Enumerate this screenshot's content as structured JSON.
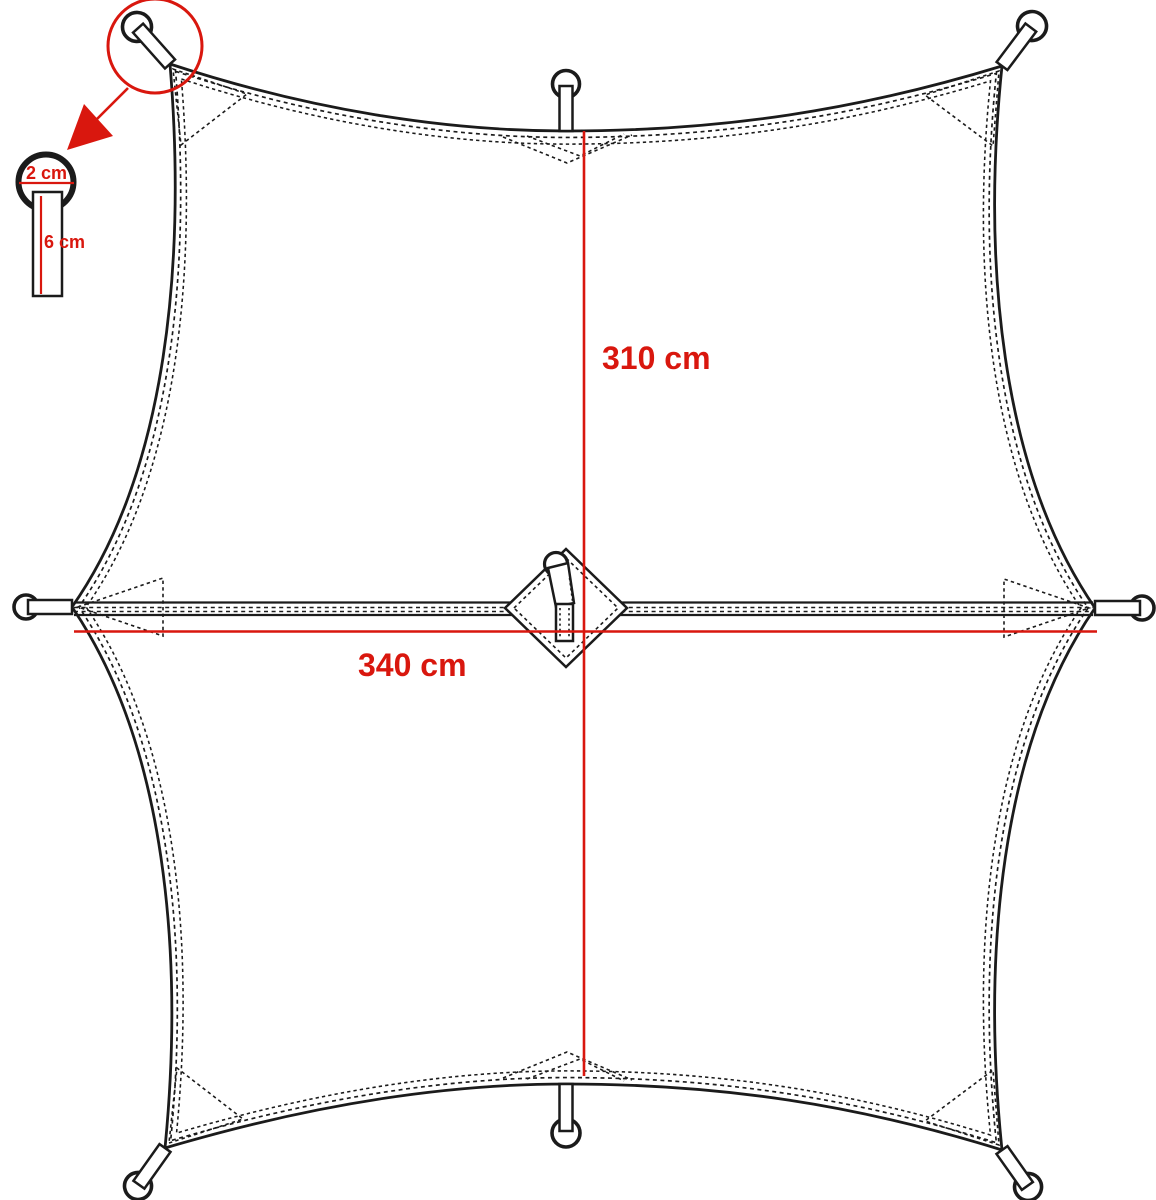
{
  "diagram": {
    "type": "tarp-dimension-diagram",
    "labels": {
      "vertical_dimension": "310 cm",
      "horizontal_dimension": "340 cm",
      "detail_ring_diameter": "2 cm",
      "detail_webbing_length": "6 cm"
    },
    "colors": {
      "annotation_red": "#d9170e",
      "outline_black": "#1b1b1b",
      "background": "#ffffff"
    },
    "features": {
      "attachment_points": 8,
      "shape": "hexagonal tarp with catenary edges",
      "center": "diamond reinforcement patch with hang loop",
      "callout": "corner loop detail inset"
    }
  }
}
